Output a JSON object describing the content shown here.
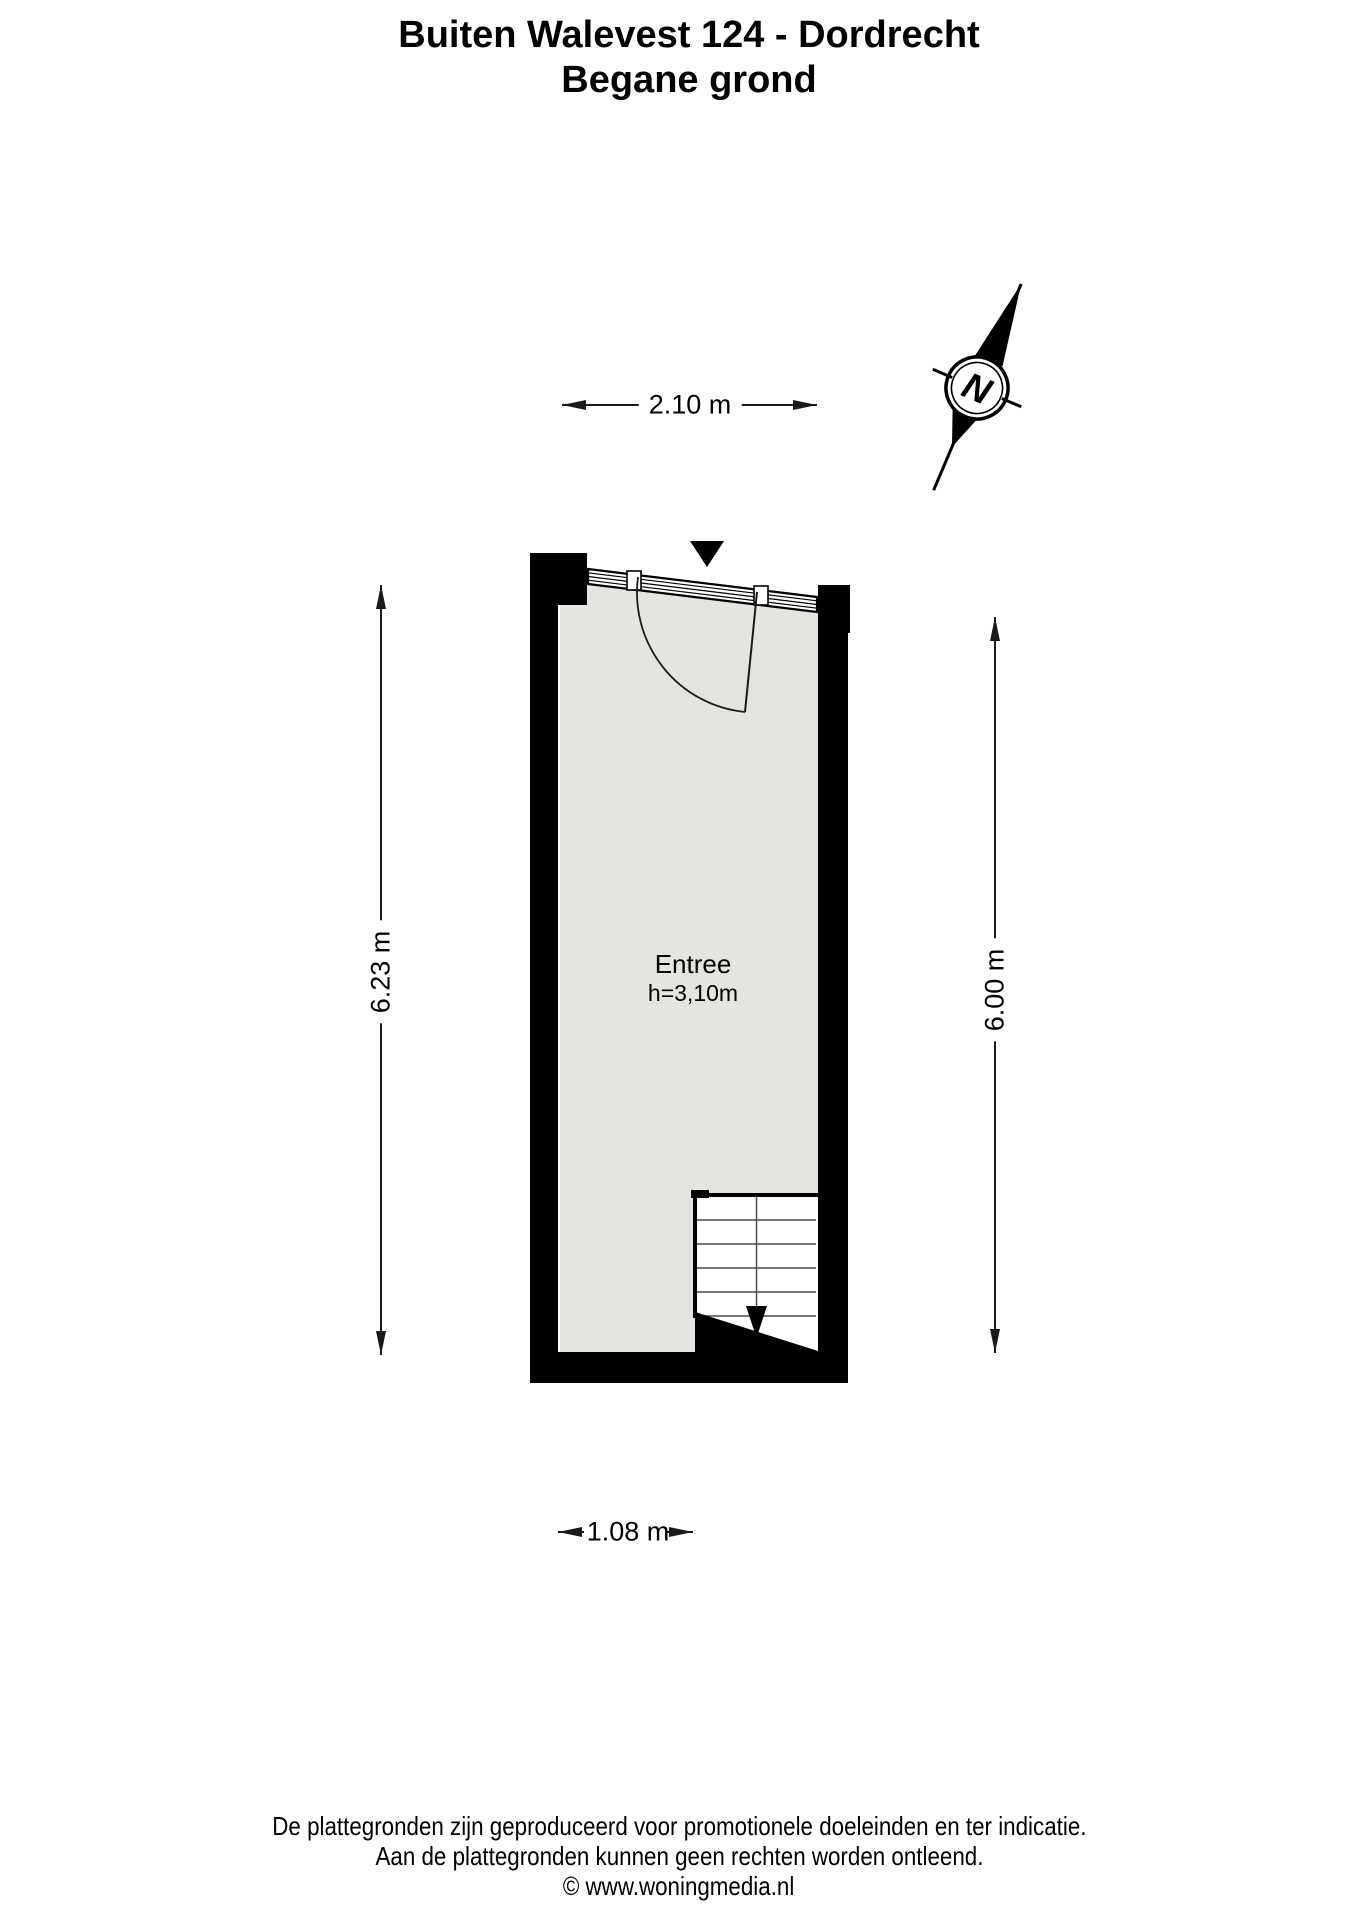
{
  "title": {
    "line1": "Buiten Walevest 124 - Dordrecht",
    "line2": "Begane grond"
  },
  "compass": {
    "label": "N"
  },
  "room": {
    "name": "Entree",
    "ceiling_height": "h=3,10m"
  },
  "dimensions": {
    "top_width": "2.10 m",
    "left_height": "6.23 m",
    "right_height": "6.00 m",
    "bottom_width": "1.08 m"
  },
  "footer": {
    "line1": "De plattegronden zijn geproduceerd voor promotionele doeleinden en ter indicatie.",
    "line2": "Aan de plattegronden kunnen geen rechten worden ontleend.",
    "line3": "© www.woningmedia.nl"
  },
  "colors": {
    "wall": "#000000",
    "floor": "#e6e4e0",
    "line": "#1a1a1a",
    "stair_line": "#4a4a4a"
  }
}
